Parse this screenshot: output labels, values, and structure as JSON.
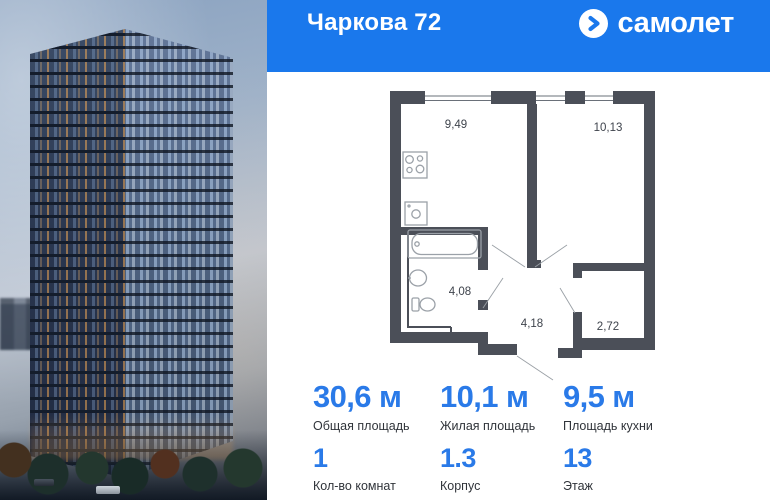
{
  "header": {
    "title": "Чаркова 72",
    "brand_name": "самолет"
  },
  "floor_plan": {
    "rooms": {
      "kitchen_area": "9,49",
      "living_room_area": "10,13",
      "bathroom_area": "4,08",
      "hallway_area": "4,18",
      "wardrobe_area": "2,72"
    }
  },
  "stats": {
    "total_area": {
      "value": "30,6 м",
      "label": "Общая площадь"
    },
    "living_area": {
      "value": "10,1 м",
      "label": "Жилая площадь"
    },
    "kitchen_area": {
      "value": "9,5 м",
      "label": "Площадь кухни"
    },
    "rooms_count": {
      "value": "1",
      "label": "Кол-во комнат"
    },
    "building": {
      "value": "1.3",
      "label": "Корпус"
    },
    "floor": {
      "value": "13",
      "label": "Этаж"
    }
  },
  "colors": {
    "brand_blue": "#1a78ec",
    "accent_blue": "#2a7ae8",
    "plan_wall": "#4b4f58"
  }
}
